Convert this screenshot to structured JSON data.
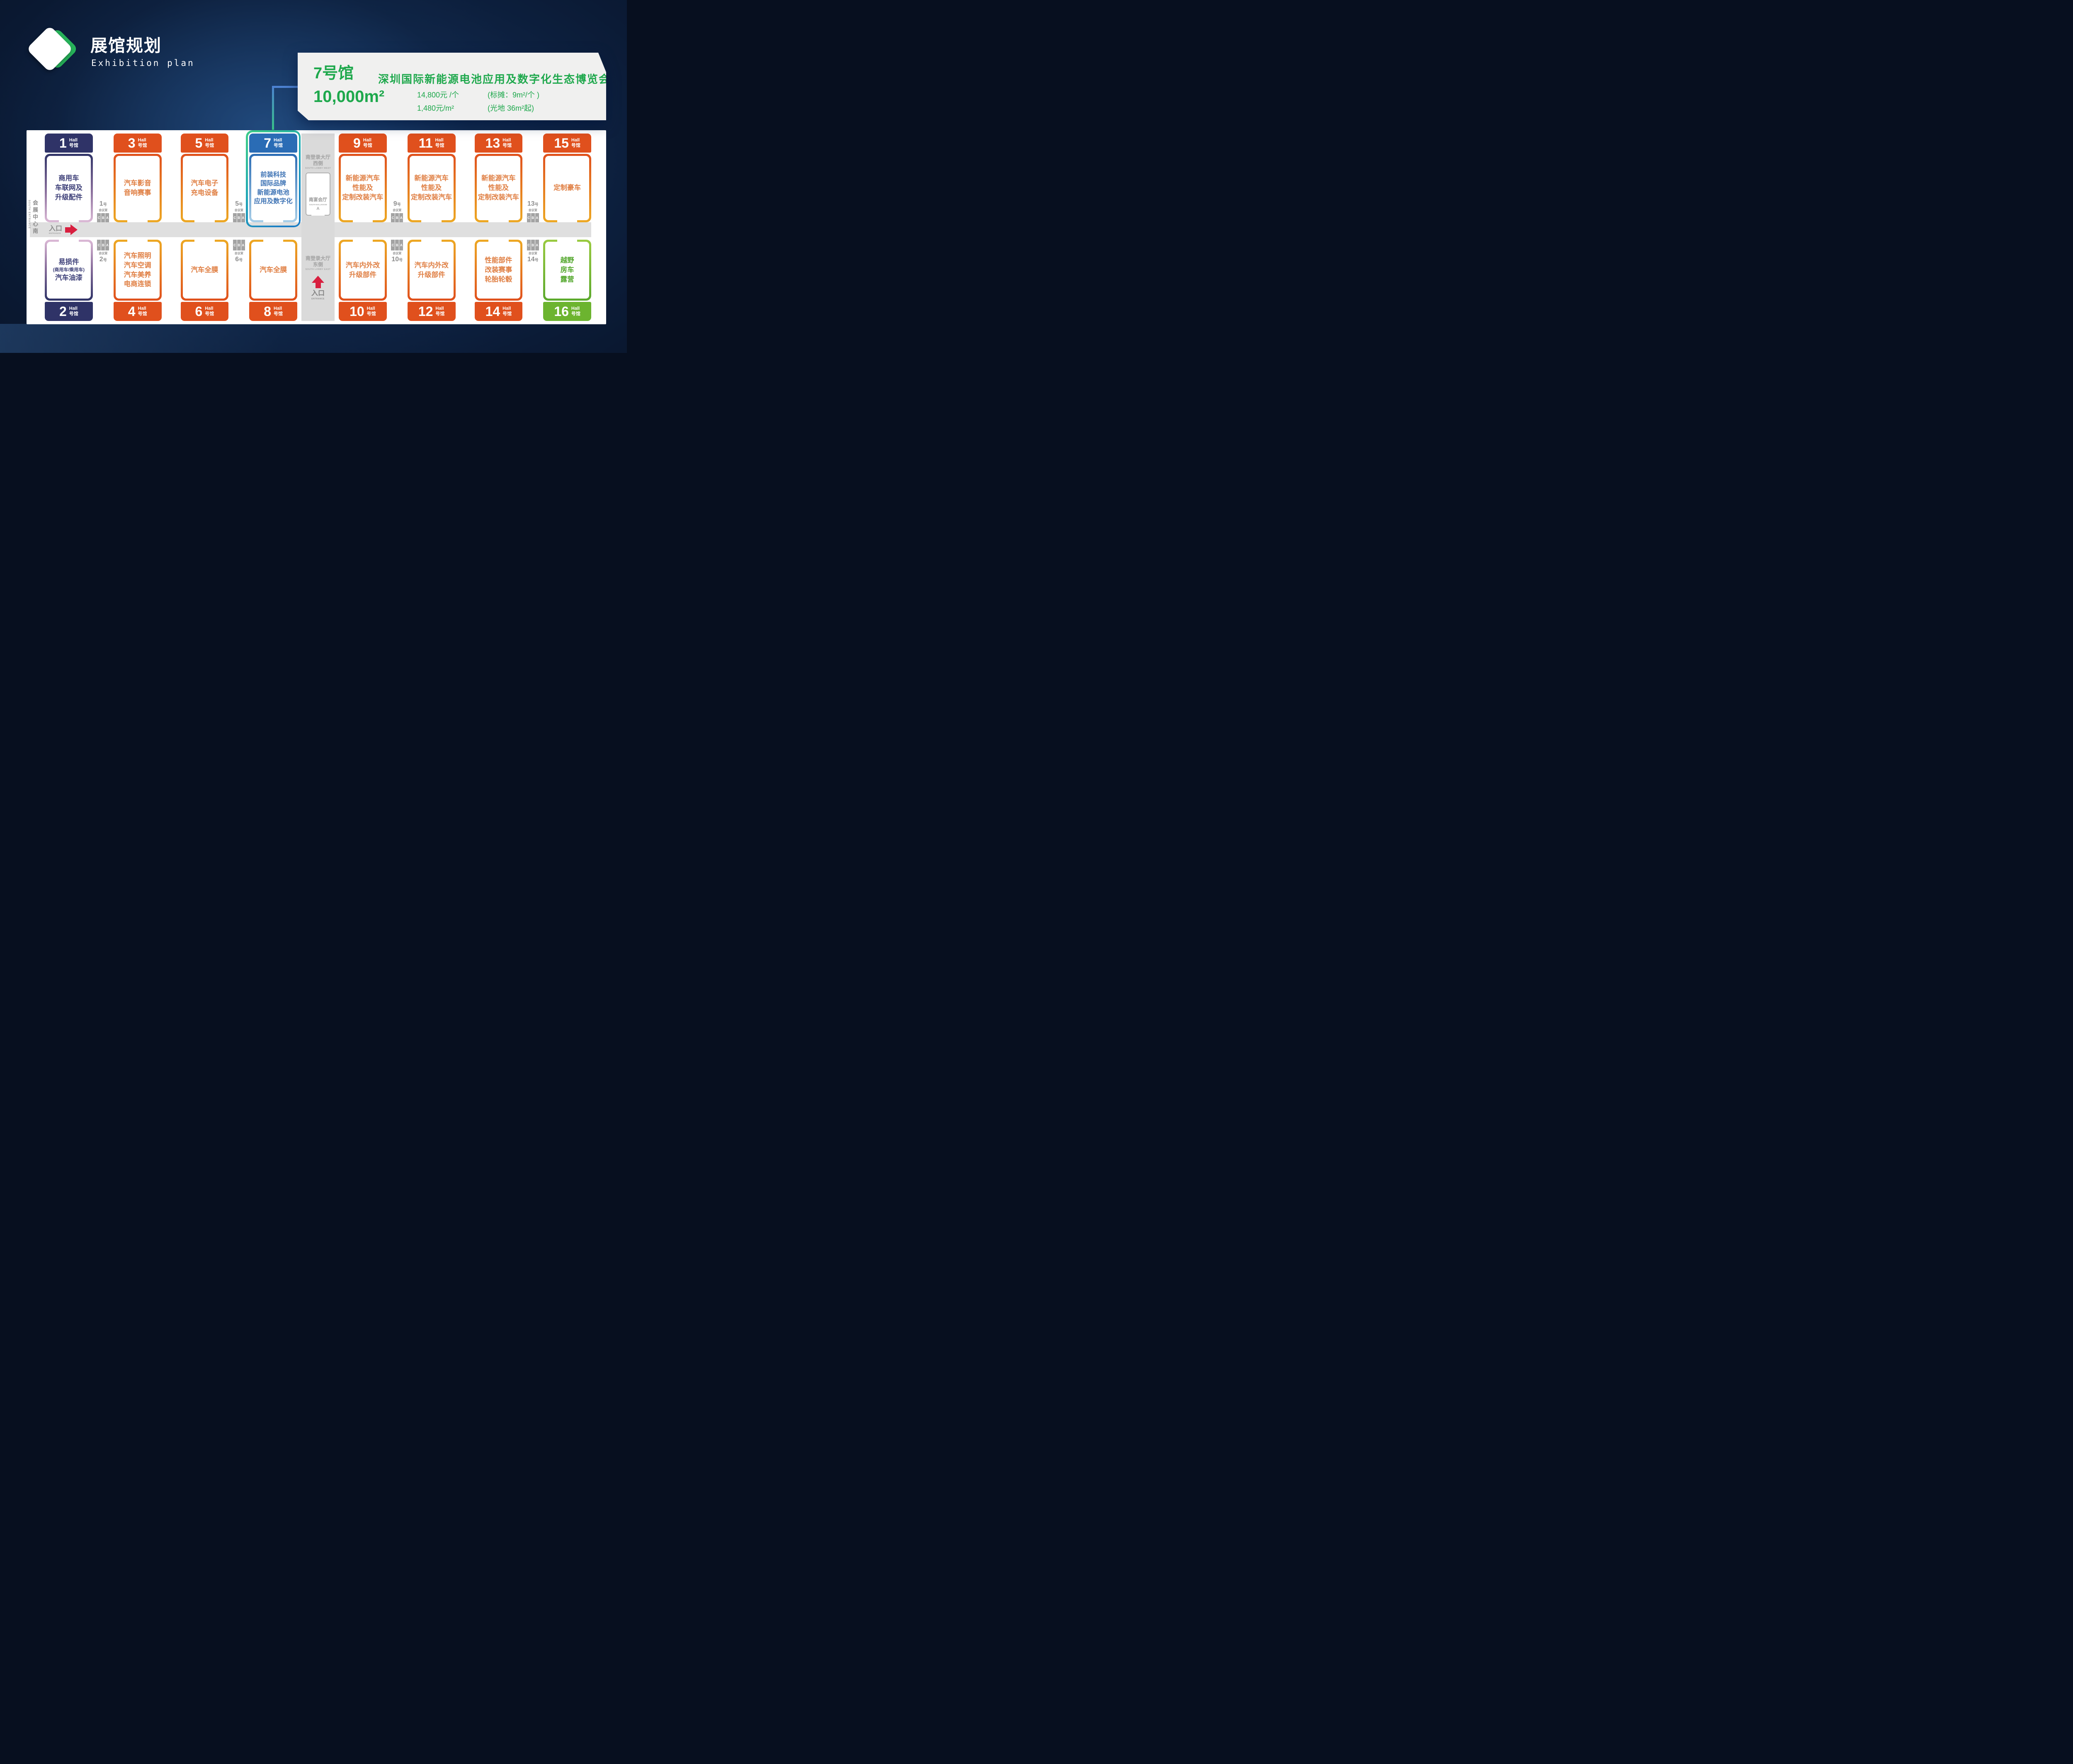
{
  "page": {
    "bg_dark": "#070f1f",
    "accent_green": "#1ea84c",
    "highlight_ring": [
      "#3bc98c",
      "#1b7ec5"
    ]
  },
  "header": {
    "title": "展馆规划",
    "subtitle": "Exhibition plan"
  },
  "callout": {
    "hall": "7号馆",
    "area": "10,000m²",
    "expo_title": "深圳国际新能源电池应用及数字化生态博览会",
    "price_booth": "14,800元 /个",
    "price_booth_note": "(标摊：9m²/个 )",
    "price_space": "1,480元/m²",
    "price_space_note": "(光地 36m²起)"
  },
  "plan": {
    "hall_en": "Hall",
    "hall_cn": "号馆",
    "south_entrance_cn": "会展中心南",
    "south_entrance_en": "SOUTH ENTRANCE",
    "corridor_entrance_cn": "入口",
    "corridor_entrance_en": "ENTRANCE",
    "meeting": {
      "label": "会议室",
      "suffix": "号",
      "letters": [
        "C",
        "B",
        "A"
      ],
      "top": [
        "1",
        "5",
        "9",
        "13"
      ],
      "bottom": [
        "2",
        "6",
        "10",
        "14"
      ]
    },
    "lobby_west": {
      "line1": "南登录大厅",
      "line2": "西侧",
      "en": "SOUTH LOBBY WEST",
      "ballroom_cn": "南宴会厅",
      "ballroom_en": "SOUTH BALLROOM",
      "ballroom_section": "A"
    },
    "lobby_east": {
      "line1": "南登录大厅",
      "line2": "东侧",
      "en": "SOUTH LOBBY EAST",
      "entrance_cn": "入口",
      "entrance_en": "ENTRANCE"
    },
    "halls": {
      "h1": {
        "num": "1",
        "content": "商用车\n车联网及\n升级配件"
      },
      "h3": {
        "num": "3",
        "content": "汽车影音\n音响赛事"
      },
      "h5": {
        "num": "5",
        "content": "汽车电子\n充电设备"
      },
      "h7": {
        "num": "7",
        "content": "前装科技\n国际品牌\n新能源电池\n应用及数字化"
      },
      "h9": {
        "num": "9",
        "content": "新能源汽车\n性能及\n定制改装汽车"
      },
      "h11": {
        "num": "11",
        "content": "新能源汽车\n性能及\n定制改装汽车"
      },
      "h13": {
        "num": "13",
        "content": "新能源汽车\n性能及\n定制改装汽车"
      },
      "h15": {
        "num": "15",
        "content": "定制豪车"
      },
      "h2": {
        "num": "2",
        "content_top": "易损件",
        "content_small": "(商用车/乘用车)",
        "content_bottom": "汽车油漆"
      },
      "h4": {
        "num": "4",
        "content": "汽车照明\n汽车空调\n汽车美养\n电商连锁"
      },
      "h6": {
        "num": "6",
        "content": "汽车全膜"
      },
      "h8": {
        "num": "8",
        "content": "汽车全膜"
      },
      "h10": {
        "num": "10",
        "content": "汽车内外改\n升级部件"
      },
      "h12": {
        "num": "12",
        "content": "汽车内外改\n升级部件"
      },
      "h14": {
        "num": "14",
        "content": "性能部件\n改装赛事\n轮胎轮毂"
      },
      "h16": {
        "num": "16",
        "content": "越野\n房车\n露营"
      }
    }
  }
}
